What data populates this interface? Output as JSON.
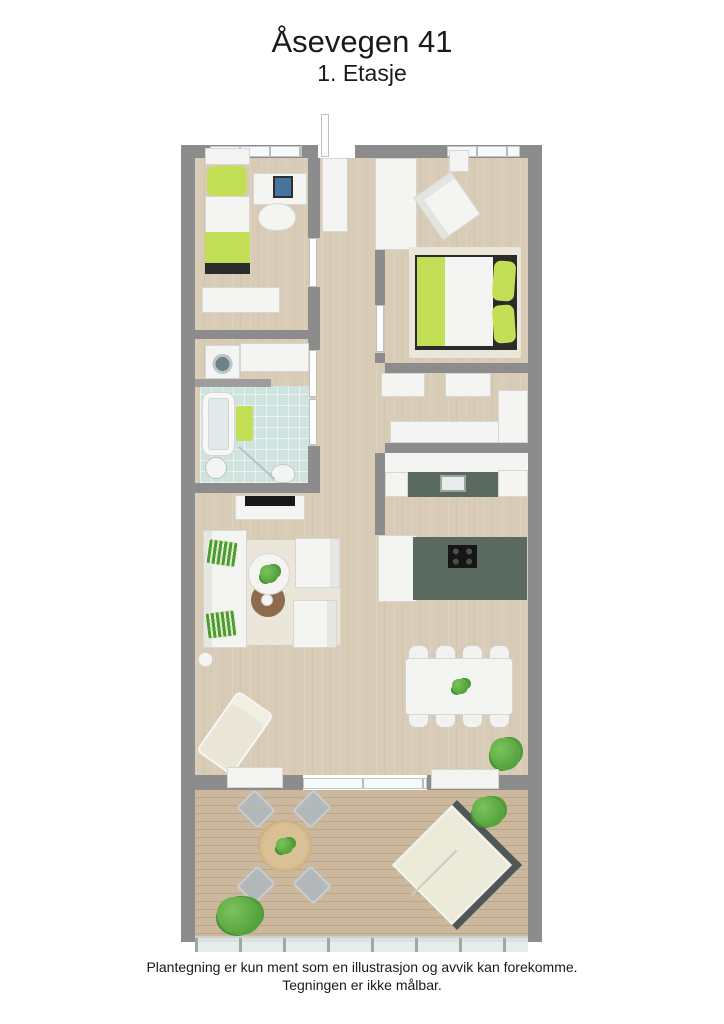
{
  "page": {
    "title": "Åsevegen 41",
    "subtitle": "1. Etasje"
  },
  "footer": {
    "line1": "Plantegning er kun ment som en illustrasjon og avvik kan forekomme.",
    "line2": "Tegningen er ikke målbar."
  },
  "colors": {
    "wall": "#8c8c8c",
    "wall_light": "#9d9d9d",
    "floor_wood": "#d9ccb7",
    "terrace_deck": "#ccb89d",
    "bathroom_tile": "#cfe3df",
    "accent_green": "#c3df55",
    "plant_green": "#55a33d",
    "kitchen_counter": "#5b6a60",
    "rug": "#ebe6da",
    "dark_base": "#2b2b2b",
    "white_furniture": "#f4f4f2"
  },
  "floorplan": {
    "style": "3d-top-down-render",
    "rooms": [
      {
        "id": "bedroom-1",
        "furniture": [
          "single-bed",
          "desk",
          "monitor",
          "office-chair",
          "sideboard",
          "window"
        ]
      },
      {
        "id": "entry-hall",
        "furniture": [
          "front-door",
          "entry-closet"
        ]
      },
      {
        "id": "bedroom-2",
        "furniture": [
          "double-bed",
          "armchair",
          "closet-cabinet",
          "window"
        ]
      },
      {
        "id": "laundry",
        "furniture": [
          "washing-machine",
          "counter"
        ]
      },
      {
        "id": "bathroom",
        "furniture": [
          "bathtub",
          "bath-mat",
          "sink",
          "toilet",
          "shower-glass"
        ]
      },
      {
        "id": "walk-in-closet",
        "furniture": [
          "wardrobe-doors",
          "sideboard",
          "tall-cabinet"
        ]
      },
      {
        "id": "kitchen",
        "furniture": [
          "counter-with-sink",
          "island-with-cooktop",
          "cabinets"
        ]
      },
      {
        "id": "living-room",
        "furniture": [
          "sofa",
          "green-pillows",
          "coffee-table",
          "side-table",
          "armchairs",
          "rug",
          "tv-bench",
          "tv",
          "chaise-lounge",
          "floor-lamp",
          "plant"
        ]
      },
      {
        "id": "dining-area",
        "furniture": [
          "dining-table",
          "eight-chairs",
          "table-plant"
        ]
      },
      {
        "id": "terrace",
        "furniture": [
          "round-table",
          "four-chairs",
          "double-sun-lounger",
          "planter-boxes",
          "plants",
          "glass-railing",
          "sliding-door"
        ]
      }
    ]
  }
}
